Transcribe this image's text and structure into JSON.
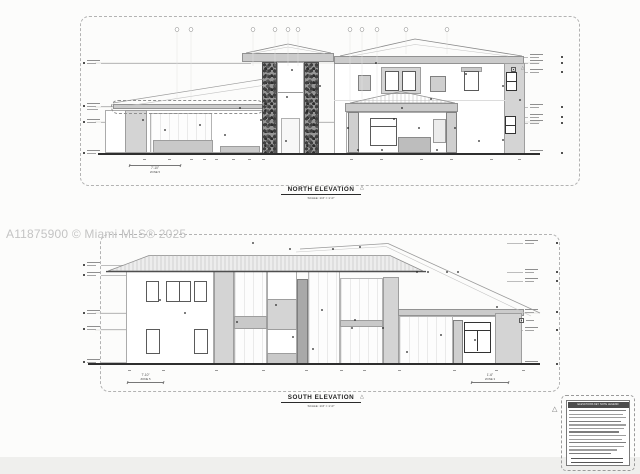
{
  "watermark_text": "A11875900 © Miami MLS® 2025",
  "sheets": {
    "north": {
      "title": "NORTH ELEVATION",
      "scale": "SCALE: 1/4\" = 1'-0\"",
      "dim_left": "7'-10\"",
      "dim_left_zone": "ZONE 5"
    },
    "south": {
      "title": "SOUTH ELEVATION",
      "scale": "SCALE: 1/4\" = 1'-0\"",
      "dim_left": "7'-10\"",
      "dim_left_zone": "ZONE 5",
      "dim_right": "1'-6\"",
      "dim_right_zone": "ZONE 3"
    }
  },
  "legend": {
    "title": "ELEVATIONS KEY NOTE LEGEND"
  },
  "colors": {
    "paper": "#fcfcfb",
    "ink": "#2e2e2e",
    "gray_panel": "#d4d4d4",
    "stone": "#6b6b6b",
    "watermark": "#c4c4c4"
  }
}
